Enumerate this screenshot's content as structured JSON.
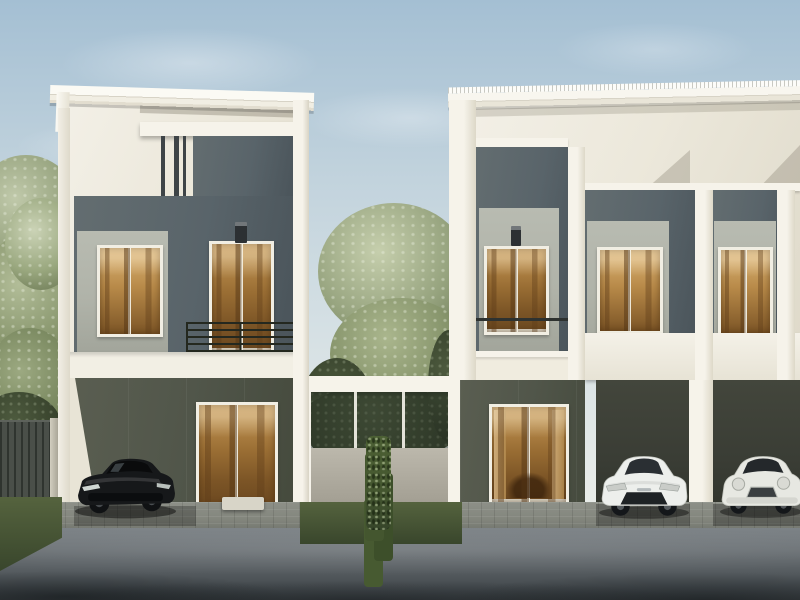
{
  "meta": {
    "type": "architectural-rendering-photo",
    "description": "Daytime exterior rendering of modern two-storey townhomes: a detached unit on the left and a row of three units on the right, separated by a gated courtyard with an ivy column. Warm lit windows, a black sedan, a white hatchback and a white mini parked in carports, asphalt driveway in front."
  },
  "palette": {
    "sky_top": "#a4bfd3",
    "sky_mid": "#c2d3dd",
    "sky_horizon": "#e7ebe8",
    "wall_cream": "#ece8db",
    "wall_white": "#f6f3ea",
    "frame_white": "#f1eee3",
    "panel_dark": "#59646a",
    "panel_light": "#b0b3a9",
    "stripe_dark": "#3e4447",
    "glass_warm_hi": "#dcb577",
    "glass_warm_mid": "#b88a49",
    "glass_warm_lo": "#7c5526",
    "gf_wall": "#51564a",
    "carport_dark": "#3a3d35",
    "railing_dark": "#24281f",
    "paver": "#84877e",
    "road_light": "#7d8387",
    "road_dark": "#383d40",
    "grass_light": "#55633e",
    "grass_dark": "#39462c",
    "fence_dark": "#40453f",
    "ivy_green": "#44562f",
    "car_black": "#16181a",
    "car_white": "#edefec",
    "mini_white": "#e7e8e2"
  },
  "scene": {
    "sky": {
      "clouds": 4,
      "condition": "clear with thin haze"
    },
    "left_house": {
      "storeys": 2,
      "roofline": "flat white slab, slight right-hand fall",
      "upper_features": [
        "dark grey feature panel",
        "three dark fins",
        "two-sash lit window",
        "lit balcony door",
        "black wall lamp",
        "horizontal-bar dark railing"
      ],
      "ground_features": [
        "olive recessed carport wall",
        "lit glass door with furniture silhouettes",
        "white entry step"
      ]
    },
    "courtyard": {
      "features": [
        "white connecting beam",
        "glazed fence with trees behind",
        "light grey wall",
        "ivy-covered column",
        "lawn strip"
      ]
    },
    "right_house": {
      "units_visible": 3,
      "roofline": "white ribbed metal roof, slight left-hand fall",
      "balcony_panel_colors": [
        "#9c9c98",
        "#b68b50",
        "#c49a5c",
        "#8a6a3a",
        "#33373a"
      ],
      "upper_features": [
        "glass-panel balcony with brackets",
        "lit balcony door with wall lamp",
        "two lit two-sash windows on light panels"
      ],
      "ground_features": [
        "lit glass living-room door with curtains and dining set",
        "two open carports",
        "white pillar"
      ]
    },
    "vehicles": [
      {
        "type": "sedan",
        "color_name": "black",
        "position": "left carport"
      },
      {
        "type": "hatchback",
        "color_name": "white",
        "position": "centre-right carport"
      },
      {
        "type": "mini",
        "color_name": "white",
        "position": "far-right carport, edge-cropped"
      }
    ],
    "landscape": {
      "left": "sage green tree over dark slatted fence",
      "center": "airy sage tree between the buildings",
      "ground": "paver apron, asphalt drive darkening to foreground"
    }
  }
}
